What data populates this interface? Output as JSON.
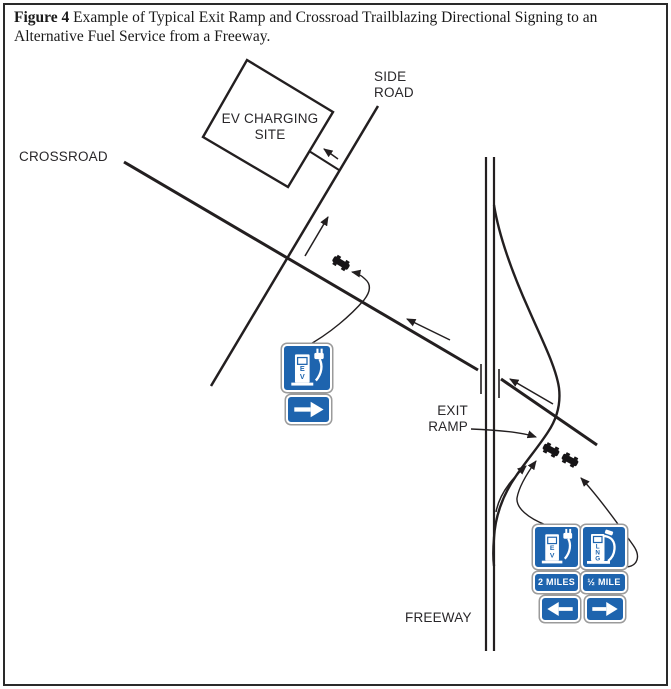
{
  "title": {
    "figure_label": "Figure 4",
    "text": "Example of Typical Exit Ramp and Crossroad Trailblazing Directional Signing to an Alternative Fuel Service from a Freeway."
  },
  "labels": {
    "crossroad": "CROSSROAD",
    "side_road": [
      "SIDE",
      "ROAD"
    ],
    "exit_ramp": [
      "EXIT",
      "RAMP"
    ],
    "freeway": "FREEWAY",
    "ev_site": [
      "EV CHARGING",
      "SITE"
    ]
  },
  "signs": {
    "crossroad_ev_sign": {
      "service": "EV charging",
      "letters": [
        "E",
        "V"
      ],
      "arrow": "right"
    },
    "exit_ev_sign": {
      "service": "EV charging",
      "letters": [
        "E",
        "V"
      ],
      "distance": "2 MILES",
      "arrow": "left"
    },
    "exit_lng_sign": {
      "service": "LNG",
      "letters": [
        "L",
        "N",
        "G"
      ],
      "distance": "½ MILE",
      "arrow": "right"
    }
  },
  "colors": {
    "sign_blue": "#1e64ae",
    "line_black": "#231f20"
  }
}
